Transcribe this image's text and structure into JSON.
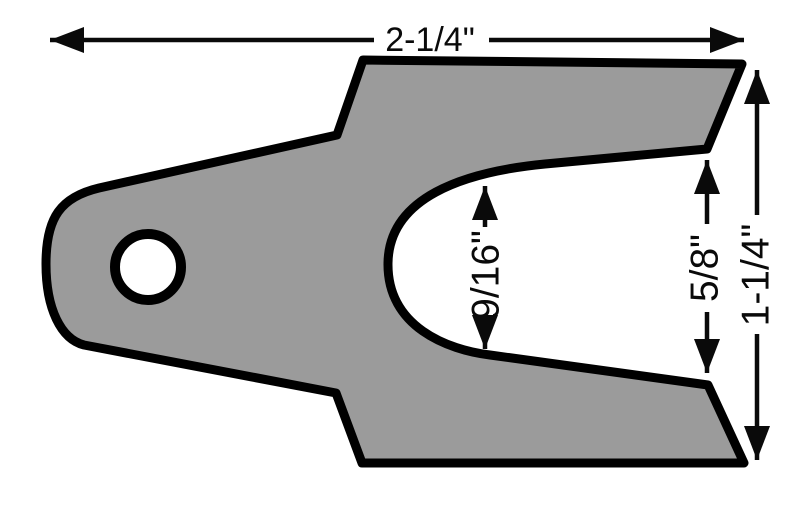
{
  "diagram": {
    "colors": {
      "part_fill": "#9b9b9b",
      "line": "#000000",
      "background": "#ffffff"
    },
    "dimensions": {
      "overall_width": {
        "label": "2-1/4\""
      },
      "slot_inner_width": {
        "label": "9/16\""
      },
      "slot_opening_width": {
        "label": "5/8\""
      },
      "overall_height": {
        "label": "1-1/4\""
      }
    }
  }
}
